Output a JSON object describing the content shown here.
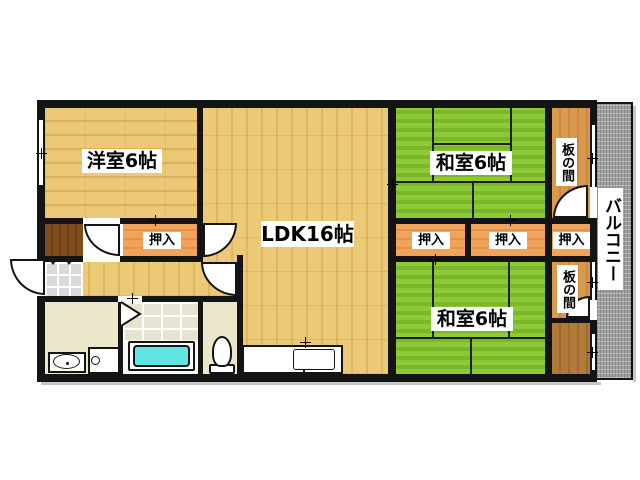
{
  "rooms": {
    "western": {
      "label": "洋室6帖"
    },
    "ldk": {
      "label": "LDK16帖"
    },
    "japanese_top": {
      "label": "和室6帖"
    },
    "japanese_bottom": {
      "label": "和室6帖"
    },
    "balcony": {
      "label": "バルコニー"
    },
    "itanoma_top": {
      "label": "板の間"
    },
    "itanoma_bottom": {
      "label": "板の間"
    },
    "closet_hall": {
      "label": "押入"
    },
    "closet_right_1": {
      "label": "押入"
    },
    "closet_right_2": {
      "label": "押入"
    },
    "closet_right_3": {
      "label": "押入"
    }
  },
  "colors": {
    "wall_black": "#141414",
    "wood_floor": "#ecc976",
    "tatami_green": "#8ccb36",
    "closet_orange": "#efa35b",
    "itanoma_wood": "#d9994f",
    "dark_wood": "#7e4d1d",
    "brown_wood": "#b07a3a",
    "wet_room_cream": "#ebe7cb",
    "bathtub_cyan": "#5fe6e4",
    "balcony_gray": "#a1a1a1"
  }
}
